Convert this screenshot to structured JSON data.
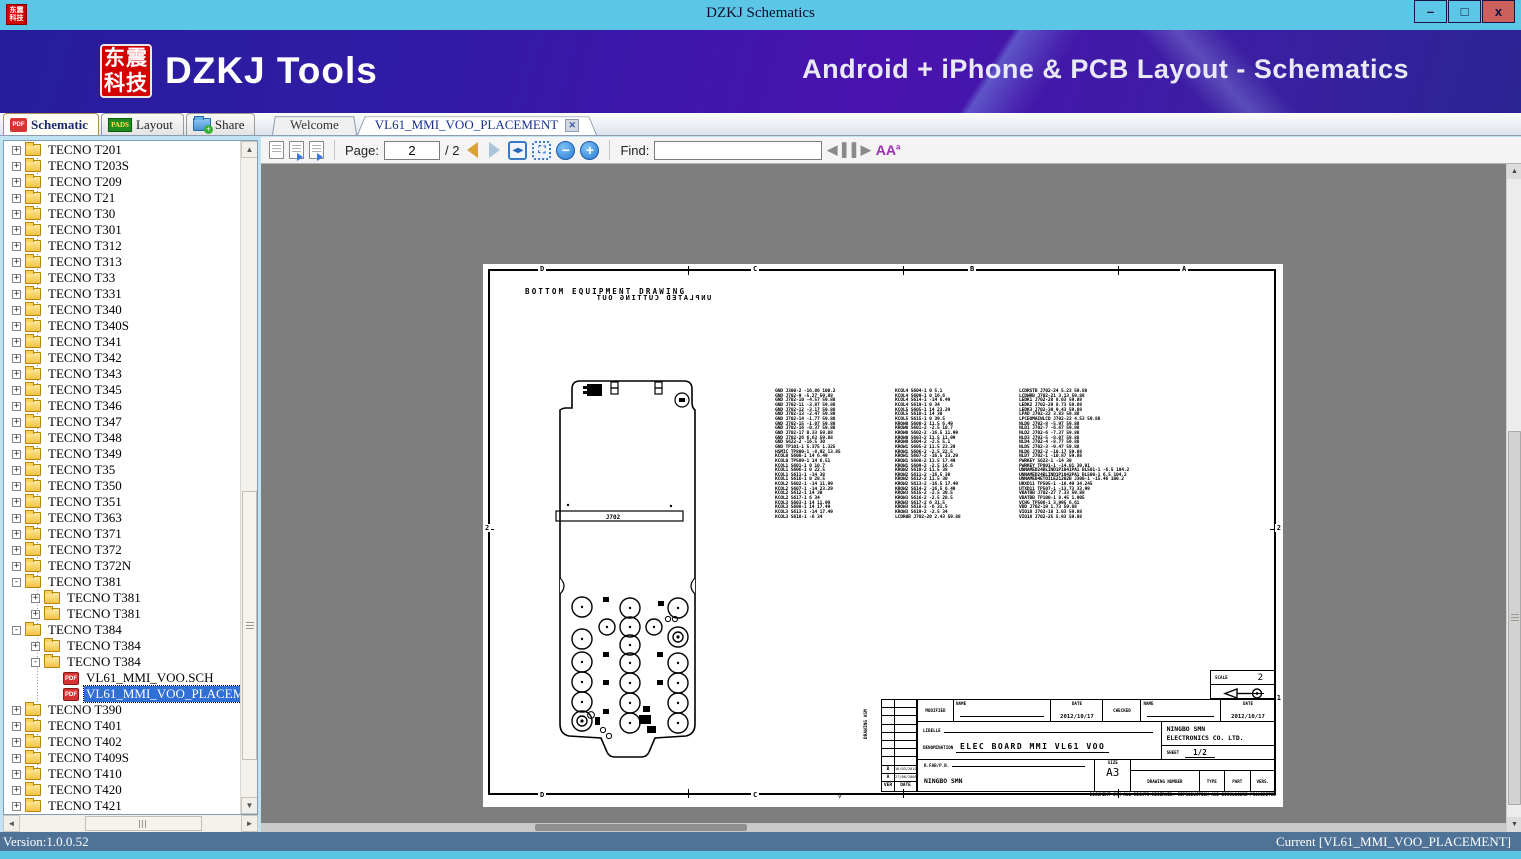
{
  "window": {
    "title": "DZKJ Schematics",
    "minimize": "–",
    "maximize": "□",
    "close": "x"
  },
  "banner": {
    "logo_line1": "东震",
    "logo_line2": "科技",
    "app_name": "DZKJ Tools",
    "tagline": "Android + iPhone & PCB Layout - Schematics"
  },
  "main_tabs": {
    "pdf_badge": "PDF",
    "schematic": "Schematic",
    "pads_badge": "PADS",
    "layout": "Layout",
    "share": "Share"
  },
  "doc_tabs": [
    {
      "label": "Welcome",
      "active": false,
      "closable": false
    },
    {
      "label": "VL61_MMI_VOO_PLACEMENT",
      "active": true,
      "closable": true
    }
  ],
  "toolbar": {
    "page_label": "Page:",
    "page_value": "2",
    "page_total": "/ 2",
    "find_label": "Find:",
    "find_value": "",
    "zoom_out": "−",
    "zoom_in": "+",
    "fit_width": "◂▸",
    "fit_page": "⛶",
    "font_icon": "A"
  },
  "sidebar": {
    "items": [
      {
        "label": "TECNO T201",
        "level": 0,
        "icon": "folder",
        "toggle": "+"
      },
      {
        "label": "TECNO T203S",
        "level": 0,
        "icon": "folder",
        "toggle": "+"
      },
      {
        "label": "TECNO T209",
        "level": 0,
        "icon": "folder",
        "toggle": "+"
      },
      {
        "label": "TECNO T21",
        "level": 0,
        "icon": "folder",
        "toggle": "+"
      },
      {
        "label": "TECNO T30",
        "level": 0,
        "icon": "folder",
        "toggle": "+"
      },
      {
        "label": "TECNO T301",
        "level": 0,
        "icon": "folder",
        "toggle": "+"
      },
      {
        "label": "TECNO T312",
        "level": 0,
        "icon": "folder",
        "toggle": "+"
      },
      {
        "label": "TECNO T313",
        "level": 0,
        "icon": "folder",
        "toggle": "+"
      },
      {
        "label": "TECNO T33",
        "level": 0,
        "icon": "folder",
        "toggle": "+"
      },
      {
        "label": "TECNO T331",
        "level": 0,
        "icon": "folder",
        "toggle": "+"
      },
      {
        "label": "TECNO T340",
        "level": 0,
        "icon": "folder",
        "toggle": "+"
      },
      {
        "label": "TECNO T340S",
        "level": 0,
        "icon": "folder",
        "toggle": "+"
      },
      {
        "label": "TECNO T341",
        "level": 0,
        "icon": "folder",
        "toggle": "+"
      },
      {
        "label": "TECNO T342",
        "level": 0,
        "icon": "folder",
        "toggle": "+"
      },
      {
        "label": "TECNO T343",
        "level": 0,
        "icon": "folder",
        "toggle": "+"
      },
      {
        "label": "TECNO T345",
        "level": 0,
        "icon": "folder",
        "toggle": "+"
      },
      {
        "label": "TECNO T346",
        "level": 0,
        "icon": "folder",
        "toggle": "+"
      },
      {
        "label": "TECNO T347",
        "level": 0,
        "icon": "folder",
        "toggle": "+"
      },
      {
        "label": "TECNO T348",
        "level": 0,
        "icon": "folder",
        "toggle": "+"
      },
      {
        "label": "TECNO T349",
        "level": 0,
        "icon": "folder",
        "toggle": "+"
      },
      {
        "label": "TECNO T35",
        "level": 0,
        "icon": "folder",
        "toggle": "+"
      },
      {
        "label": "TECNO T350",
        "level": 0,
        "icon": "folder",
        "toggle": "+"
      },
      {
        "label": "TECNO T351",
        "level": 0,
        "icon": "folder",
        "toggle": "+"
      },
      {
        "label": "TECNO T363",
        "level": 0,
        "icon": "folder",
        "toggle": "+"
      },
      {
        "label": "TECNO T371",
        "level": 0,
        "icon": "folder",
        "toggle": "+"
      },
      {
        "label": "TECNO T372",
        "level": 0,
        "icon": "folder",
        "toggle": "+"
      },
      {
        "label": "TECNO T372N",
        "level": 0,
        "icon": "folder",
        "toggle": "+"
      },
      {
        "label": "TECNO T381",
        "level": 0,
        "icon": "folder",
        "toggle": "-"
      },
      {
        "label": "TECNO T381",
        "level": 1,
        "icon": "folder",
        "toggle": "+"
      },
      {
        "label": "TECNO T381",
        "level": 1,
        "icon": "folder",
        "toggle": "+"
      },
      {
        "label": "TECNO T384",
        "level": 0,
        "icon": "folder",
        "toggle": "-"
      },
      {
        "label": "TECNO T384",
        "level": 1,
        "icon": "folder",
        "toggle": "+"
      },
      {
        "label": "TECNO T384",
        "level": 1,
        "icon": "folder",
        "toggle": "-"
      },
      {
        "label": "VL61_MMI_VOO.SCH",
        "level": 2,
        "icon": "pdf",
        "toggle": ""
      },
      {
        "label": "VL61_MMI_VOO_PLACEMENT",
        "level": 2,
        "icon": "pdf",
        "toggle": "",
        "selected": true
      },
      {
        "label": "TECNO T390",
        "level": 0,
        "icon": "folder",
        "toggle": "+"
      },
      {
        "label": "TECNO T401",
        "level": 0,
        "icon": "folder",
        "toggle": "+"
      },
      {
        "label": "TECNO T402",
        "level": 0,
        "icon": "folder",
        "toggle": "+"
      },
      {
        "label": "TECNO T409S",
        "level": 0,
        "icon": "folder",
        "toggle": "+"
      },
      {
        "label": "TECNO T410",
        "level": 0,
        "icon": "folder",
        "toggle": "+"
      },
      {
        "label": "TECNO T420",
        "level": 0,
        "icon": "folder",
        "toggle": "+"
      },
      {
        "label": "TECNO T421",
        "level": 0,
        "icon": "folder",
        "toggle": "+"
      }
    ]
  },
  "drawing": {
    "title": "BOTTOM EQUIPMENT DRAWING",
    "mirrored_title": "UNPLATED CUTTING OUT",
    "connector_label": "J702",
    "zones": {
      "top": [
        "D",
        "C",
        "B",
        "A"
      ],
      "bottom": [
        "D",
        "C"
      ],
      "left": [
        "2"
      ],
      "right": [
        "2",
        "1"
      ]
    },
    "placement_columns": [
      [
        "GND J300-2 -16.86 100.2",
        "GND J702-9 -5.27 59.88",
        "GND J702-10 -4.57 59.88",
        "GND J702-11 -3.87 59.88",
        "GND J702-12 -3.17 59.88",
        "GND J702-13 -2.47 59.88",
        "GND J702-14 -1.77 59.88",
        "GND J702-15 -1.07 59.88",
        "GND J702-16 -0.37 59.88",
        "GND J702-17 0.33 59.88",
        "GND J702-26 6.63 59.88",
        "GND S622-2 -16.5 30",
        "GND TP101-1 5.375 1.325",
        "HSMIC TP800-1 -8.92 13.85",
        "KCOL0 S600-1 14 6.49",
        "KCOL0 TP509-1 14 6.51",
        "KCOL1 S601-1 0 10.7",
        "KCOL1 S606-1 0 22.5",
        "KCOL1 S611-1 -14 38",
        "KCOL1 S616-1 0 28.5",
        "KCOL2 S602-1 -14 11.99",
        "KCOL2 S607-1 -14 23.29",
        "KCOL2 S612-1 14 30",
        "KCOL2 S617-1 6 34",
        "KCOL3 S603-1 14 11.99",
        "KCOL3 S608-1 14 17.49",
        "KCOL3 S613-1 -14 17.49",
        "KCOL3 S618-1 -6 34"
      ],
      [
        "KCOL4 S604-1 0 5.1",
        "KCOL4 S609-1 0 16.6",
        "KCOL4 S614-1 -14 6.49",
        "KCOL4 S619-1 0 34",
        "KCOL5 S605-1 14 23.29",
        "KCOL5 S610-1 14 38",
        "KCOL5 S615-1 0 39.5",
        "KROW0 S600-2 11.5 6.49",
        "KROW0 S601-2 -2.5 10.7",
        "KROW0 S602-2 -16.5 11.99",
        "KROW0 S603-2 11.5 11.99",
        "KROW0 S604-2 -2.5 5.1",
        "KROW1 S605-2 11.5 23.29",
        "KROW1 S606-2 -2.5 22.5",
        "KROW1 S607-2 -16.5 23.29",
        "KROW1 S608-2 11.5 17.49",
        "KROW1 S609-2 -2.5 16.6",
        "KROW2 S610-2 11.5 38",
        "KROW2 S611-2 -16.5 38",
        "KROW2 S612-2 11.5 30",
        "KROW2 S613-2 -16.5 17.49",
        "KROW2 S614-2 -16.5 6.49",
        "KROW3 S615-2 -2.5 39.5",
        "KROW3 S616-2 -2.5 28.5",
        "KROW3 S617-2 6 31.5",
        "KROW3 S618-2 -6 31.5",
        "KROW3 S619-2 -2.5 34",
        "LCDR0B J702-20 2.43 59.88"
      ],
      [
        "LCDRSTB J702-24 5.23 59.88",
        "LCDWRB J702-21 3.13 59.88",
        "LEDK1 J702-28 8.03 59.88",
        "LEDK2 J702-29 8.73 59.88",
        "LEDK3 J702-30 9.43 59.88",
        "LPAD J702-22 3.83 59.88",
        "LPCEOMAINLCD J702-23 4.53 59.88",
        "NLD0 J702-8 -5.97 59.88",
        "NLD1 J702-7 -6.67 59.88",
        "NLD2 J702-6 -7.37 59.88",
        "NLD3 J702-5 -8.07 59.88",
        "NLD4 J702-4 -8.77 59.88",
        "NLD5 J702-3 -9.47 59.88",
        "NLD6 J702-2 -10.17 59.88",
        "NLD7 J702-1 -10.87 59.88",
        "PWRKEY S622-1 -14 30",
        "PWRKEY TP801-1 -14.01 30.01",
        "UNNAMED24BLIND1P1041PA1 BL501-1 -6.5 104.2",
        "UNNAMED24BLIND1P1042PA1 BL500-1 6.5 104.2",
        "UNNAMED4ETOILE21202B J300-1 -15.46 100.2",
        "URXD11 TP505-1 -16.49 34.245",
        "UTXD11 TP507-1 -13.73 33.99",
        "VBATBB J702-27 7.33 59.88",
        "VBATBB TP100-1 8.45 1.905",
        "VCHG TP506-1 3.995 6.61",
        "VDD J702-19 1.73 59.88",
        "VIO18 J702-18 1.03 59.88",
        "VIO18 J702-25 5.93 59.88"
      ]
    ],
    "titleblock": {
      "scale_label": "SCALE",
      "scale_value": "2",
      "modified_label": "MODIFIED",
      "checked_label": "CHECKED",
      "name_label": "NAME",
      "name_label2": "NAME",
      "date_label": "DATE",
      "date_label2": "DATE",
      "modified_date": "2012/10/17",
      "checked_date": "2012/10/17",
      "libelle_label": "LIBELLE",
      "denomination_label": "DENOMINATION",
      "denomination_value": "ELEC BOARD MMI VL61 VOO",
      "company_line1": "NINGBO SMN",
      "company_line2": "ELECTRONICS CO. LTD.",
      "sheet_label": "SHEET",
      "sheet_value": "1/2",
      "rfab_label": "R.FAB/P.N.",
      "maker": "NINGBO SMN",
      "size_label": "SIZE",
      "size_value": "A3",
      "drawing_number_label": "DRAWING NUMBER",
      "type_label": "TYPE",
      "part_label": "PART",
      "vers_label": "VERS.",
      "ver_label": "VER",
      "date_col_label": "DATE",
      "rev_rows": [
        {
          "rev": "B",
          "date": "16/03/2010"
        },
        {
          "rev": "A",
          "date": "27/08/2008"
        }
      ],
      "side_label": "DRAWING ASM",
      "footer_note": "DOCUMENT SMN ALL RIGHTS RESERVED. REPRODUCTION AND DISCLOSURE PROHIBITED"
    }
  },
  "statusbar": {
    "version": "Version:1.0.0.52",
    "current": "Current [VL61_MMI_VOO_PLACEMENT]"
  }
}
